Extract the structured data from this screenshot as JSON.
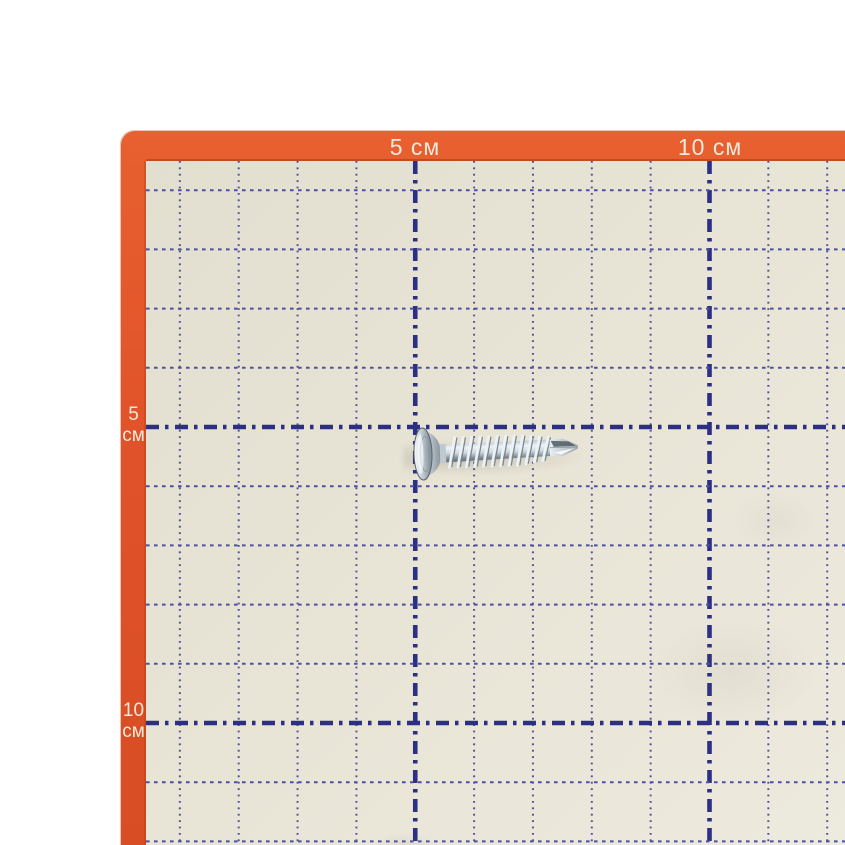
{
  "photo": {
    "subject": "Zinc-plated self-drilling wafer-head screw",
    "surface": "Cutting mat with centimeter grid"
  },
  "ruler": {
    "unit_label": "см",
    "top_labels": [
      {
        "text": "5 см",
        "cm": 5
      },
      {
        "text": "10 см",
        "cm": 10
      }
    ],
    "left_labels": [
      {
        "value": "5",
        "unit": "см",
        "cm": 5
      },
      {
        "value": "10",
        "unit": "см",
        "cm": 10
      }
    ],
    "fine_step_cm": 1,
    "heavy_step_cm": 5
  },
  "colors": {
    "mat_border_orange": "#e0522a",
    "mat_surface_cream": "#e7e3d5",
    "grid_fine_blue": "#4d509c",
    "grid_heavy_navy": "#2c2f82",
    "label_text": "#f2e9da",
    "page_background": "#ffffff",
    "screw_metal_light": "#eef3f6",
    "screw_metal_dark": "#6e7a83"
  }
}
